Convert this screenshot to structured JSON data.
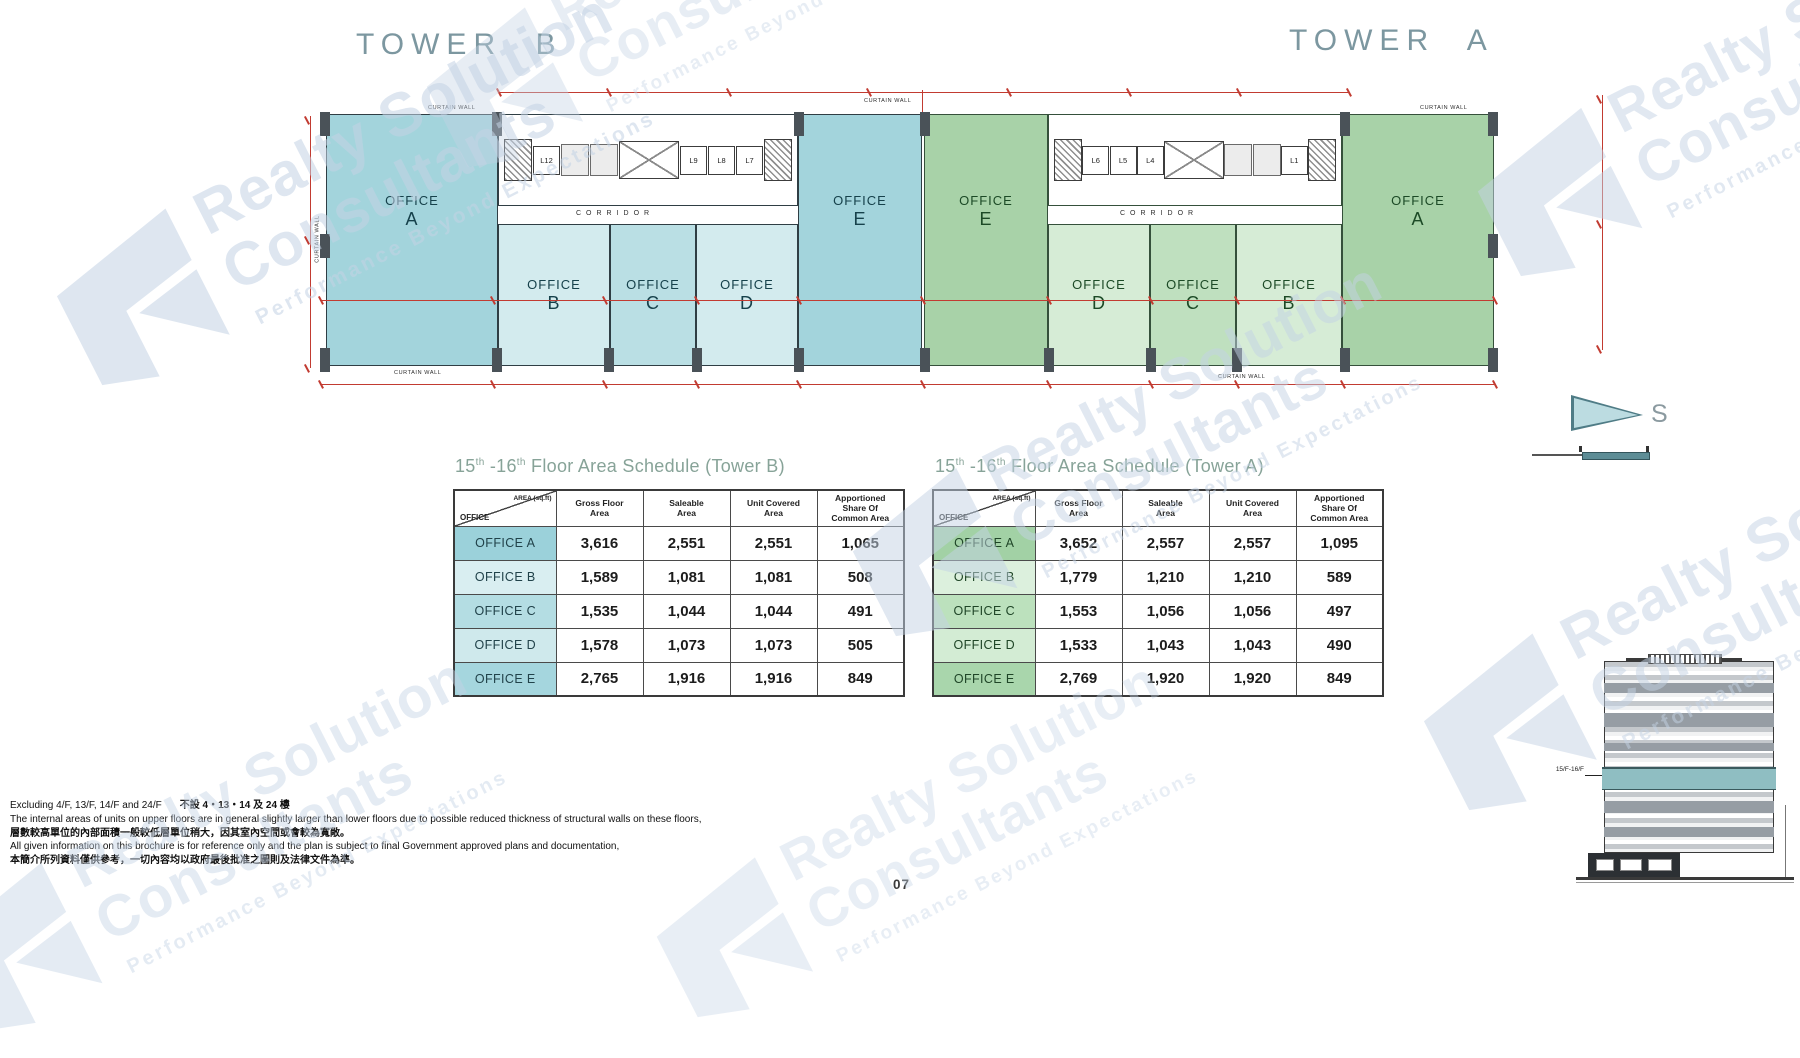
{
  "page": {
    "number": "07"
  },
  "watermark": {
    "line1": "Realty Solution",
    "line2": "Consultants",
    "tagline": "Performance Beyond Expectations",
    "color": "#c4d3e5"
  },
  "plan": {
    "corridor": "CORRIDOR",
    "curtain_wall": "CURTAIN WALL",
    "compass": "S",
    "towers": [
      {
        "title": "TOWER B",
        "lifts": [
          "L12",
          "L9",
          "L8",
          "L7"
        ],
        "offices": [
          {
            "line1": "OFFICE",
            "line2": "A"
          },
          {
            "line1": "OFFICE",
            "line2": "B"
          },
          {
            "line1": "OFFICE",
            "line2": "C"
          },
          {
            "line1": "OFFICE",
            "line2": "D"
          },
          {
            "line1": "OFFICE",
            "line2": "E"
          }
        ]
      },
      {
        "title": "TOWER A",
        "lifts": [
          "L6",
          "L5",
          "L4",
          "L1"
        ],
        "offices": [
          {
            "line1": "OFFICE",
            "line2": "A"
          },
          {
            "line1": "OFFICE",
            "line2": "B"
          },
          {
            "line1": "OFFICE",
            "line2": "C"
          },
          {
            "line1": "OFFICE",
            "line2": "D"
          },
          {
            "line1": "OFFICE",
            "line2": "E"
          }
        ]
      }
    ]
  },
  "schedules": [
    {
      "tower": "B",
      "title": {
        "n1": "15",
        "s1": "th",
        "n2": " -16",
        "s2": "th",
        "rest": " Floor Area Schedule (Tower  B)"
      },
      "header": {
        "corner_top": "AREA (sq.ft)",
        "corner_bottom": "OFFICE",
        "columns": [
          "Gross Floor\nArea",
          "Saleable\nArea",
          "Unit Covered\nArea",
          "Apportioned\nShare Of\nCommon Area"
        ]
      },
      "rows": [
        {
          "label": "OFFICE A",
          "values": [
            "3,616",
            "2,551",
            "2,551",
            "1,065"
          ]
        },
        {
          "label": "OFFICE B",
          "values": [
            "1,589",
            "1,081",
            "1,081",
            "508"
          ]
        },
        {
          "label": "OFFICE C",
          "values": [
            "1,535",
            "1,044",
            "1,044",
            "491"
          ]
        },
        {
          "label": "OFFICE D",
          "values": [
            "1,578",
            "1,073",
            "1,073",
            "505"
          ]
        },
        {
          "label": "OFFICE E",
          "values": [
            "2,765",
            "1,916",
            "1,916",
            "849"
          ]
        }
      ]
    },
    {
      "tower": "A",
      "title": {
        "n1": "15",
        "s1": "th",
        "n2": " -16",
        "s2": "th",
        "rest": " Floor Area Schedule (Tower  A)"
      },
      "header": {
        "corner_top": "AREA (sq.ft)",
        "corner_bottom": "OFFICE",
        "columns": [
          "Gross Floor\nArea",
          "Saleable\nArea",
          "Unit Covered\nArea",
          "Apportioned\nShare Of\nCommon Area"
        ]
      },
      "rows": [
        {
          "label": "OFFICE A",
          "values": [
            "3,652",
            "2,557",
            "2,557",
            "1,095"
          ]
        },
        {
          "label": "OFFICE B",
          "values": [
            "1,779",
            "1,210",
            "1,210",
            "589"
          ]
        },
        {
          "label": "OFFICE C",
          "values": [
            "1,553",
            "1,056",
            "1,056",
            "497"
          ]
        },
        {
          "label": "OFFICE D",
          "values": [
            "1,533",
            "1,043",
            "1,043",
            "490"
          ]
        },
        {
          "label": "OFFICE E",
          "values": [
            "2,769",
            "1,920",
            "1,920",
            "849"
          ]
        }
      ]
    }
  ],
  "elevation": {
    "floor_label": "15/F-16/F"
  },
  "footnotes": [
    {
      "en": "Excluding  4/F, 13/F, 14/F and 24/F",
      "cn": "不設 4・13・14 及 24 樓"
    },
    {
      "en": "The internal areas of units on upper floors are in general slightly larger than lower floors due to possible reduced thickness of structural walls on these floors,"
    },
    {
      "cn": "層數較高單位的內部面積一般較低層單位稍大，因其室內空間或會較為寬敞。"
    },
    {
      "en": "All given information on this brochure is for reference only and the plan is subject to final Government approved plans and documentation,"
    },
    {
      "cn": "本簡介所列資料僅供參考，一切內容均以政府最後批准之圖則及法律文件為準。"
    }
  ]
}
